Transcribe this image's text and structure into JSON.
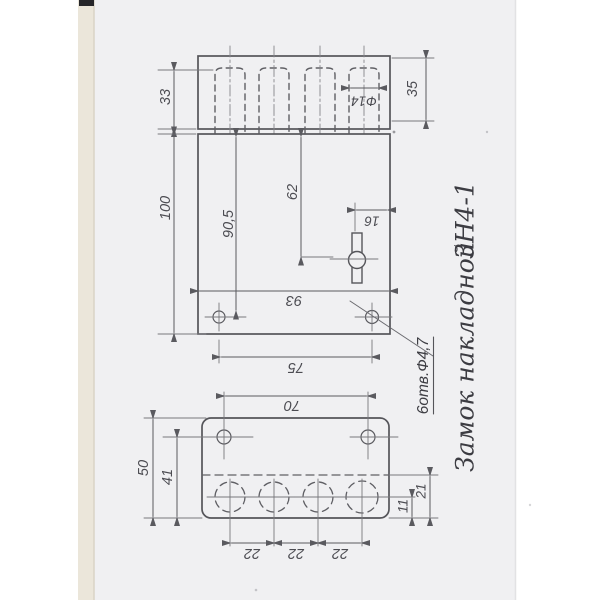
{
  "annotations": {
    "title": "Замок накладной",
    "model": "ЗН4-1",
    "holes_note": "6отв.Ф4,7"
  },
  "dimensions": {
    "top_view": {
      "slot_depth": "33",
      "block_height": "35",
      "slot_diameter": "Ф14"
    },
    "front_view": {
      "body_length": "100",
      "hole_from_top": "90,5",
      "keyhole_from_top": "62",
      "keyhole_from_edge": "16",
      "body_width": "93",
      "mount_holes_span": "75"
    },
    "face_view": {
      "plate_width": "50",
      "screw_hole_offset": "41",
      "screw_holes_span": "70",
      "pitch": [
        "22",
        "22",
        "22"
      ],
      "axis_from_edge": "21",
      "centers_from_edge": "11"
    }
  },
  "colors": {
    "paper": "#f0f0f2",
    "paper_edge": "#e9e4d8",
    "line": "#5a5a5f",
    "thin_line": "#77777c",
    "ink": "#45454a"
  }
}
